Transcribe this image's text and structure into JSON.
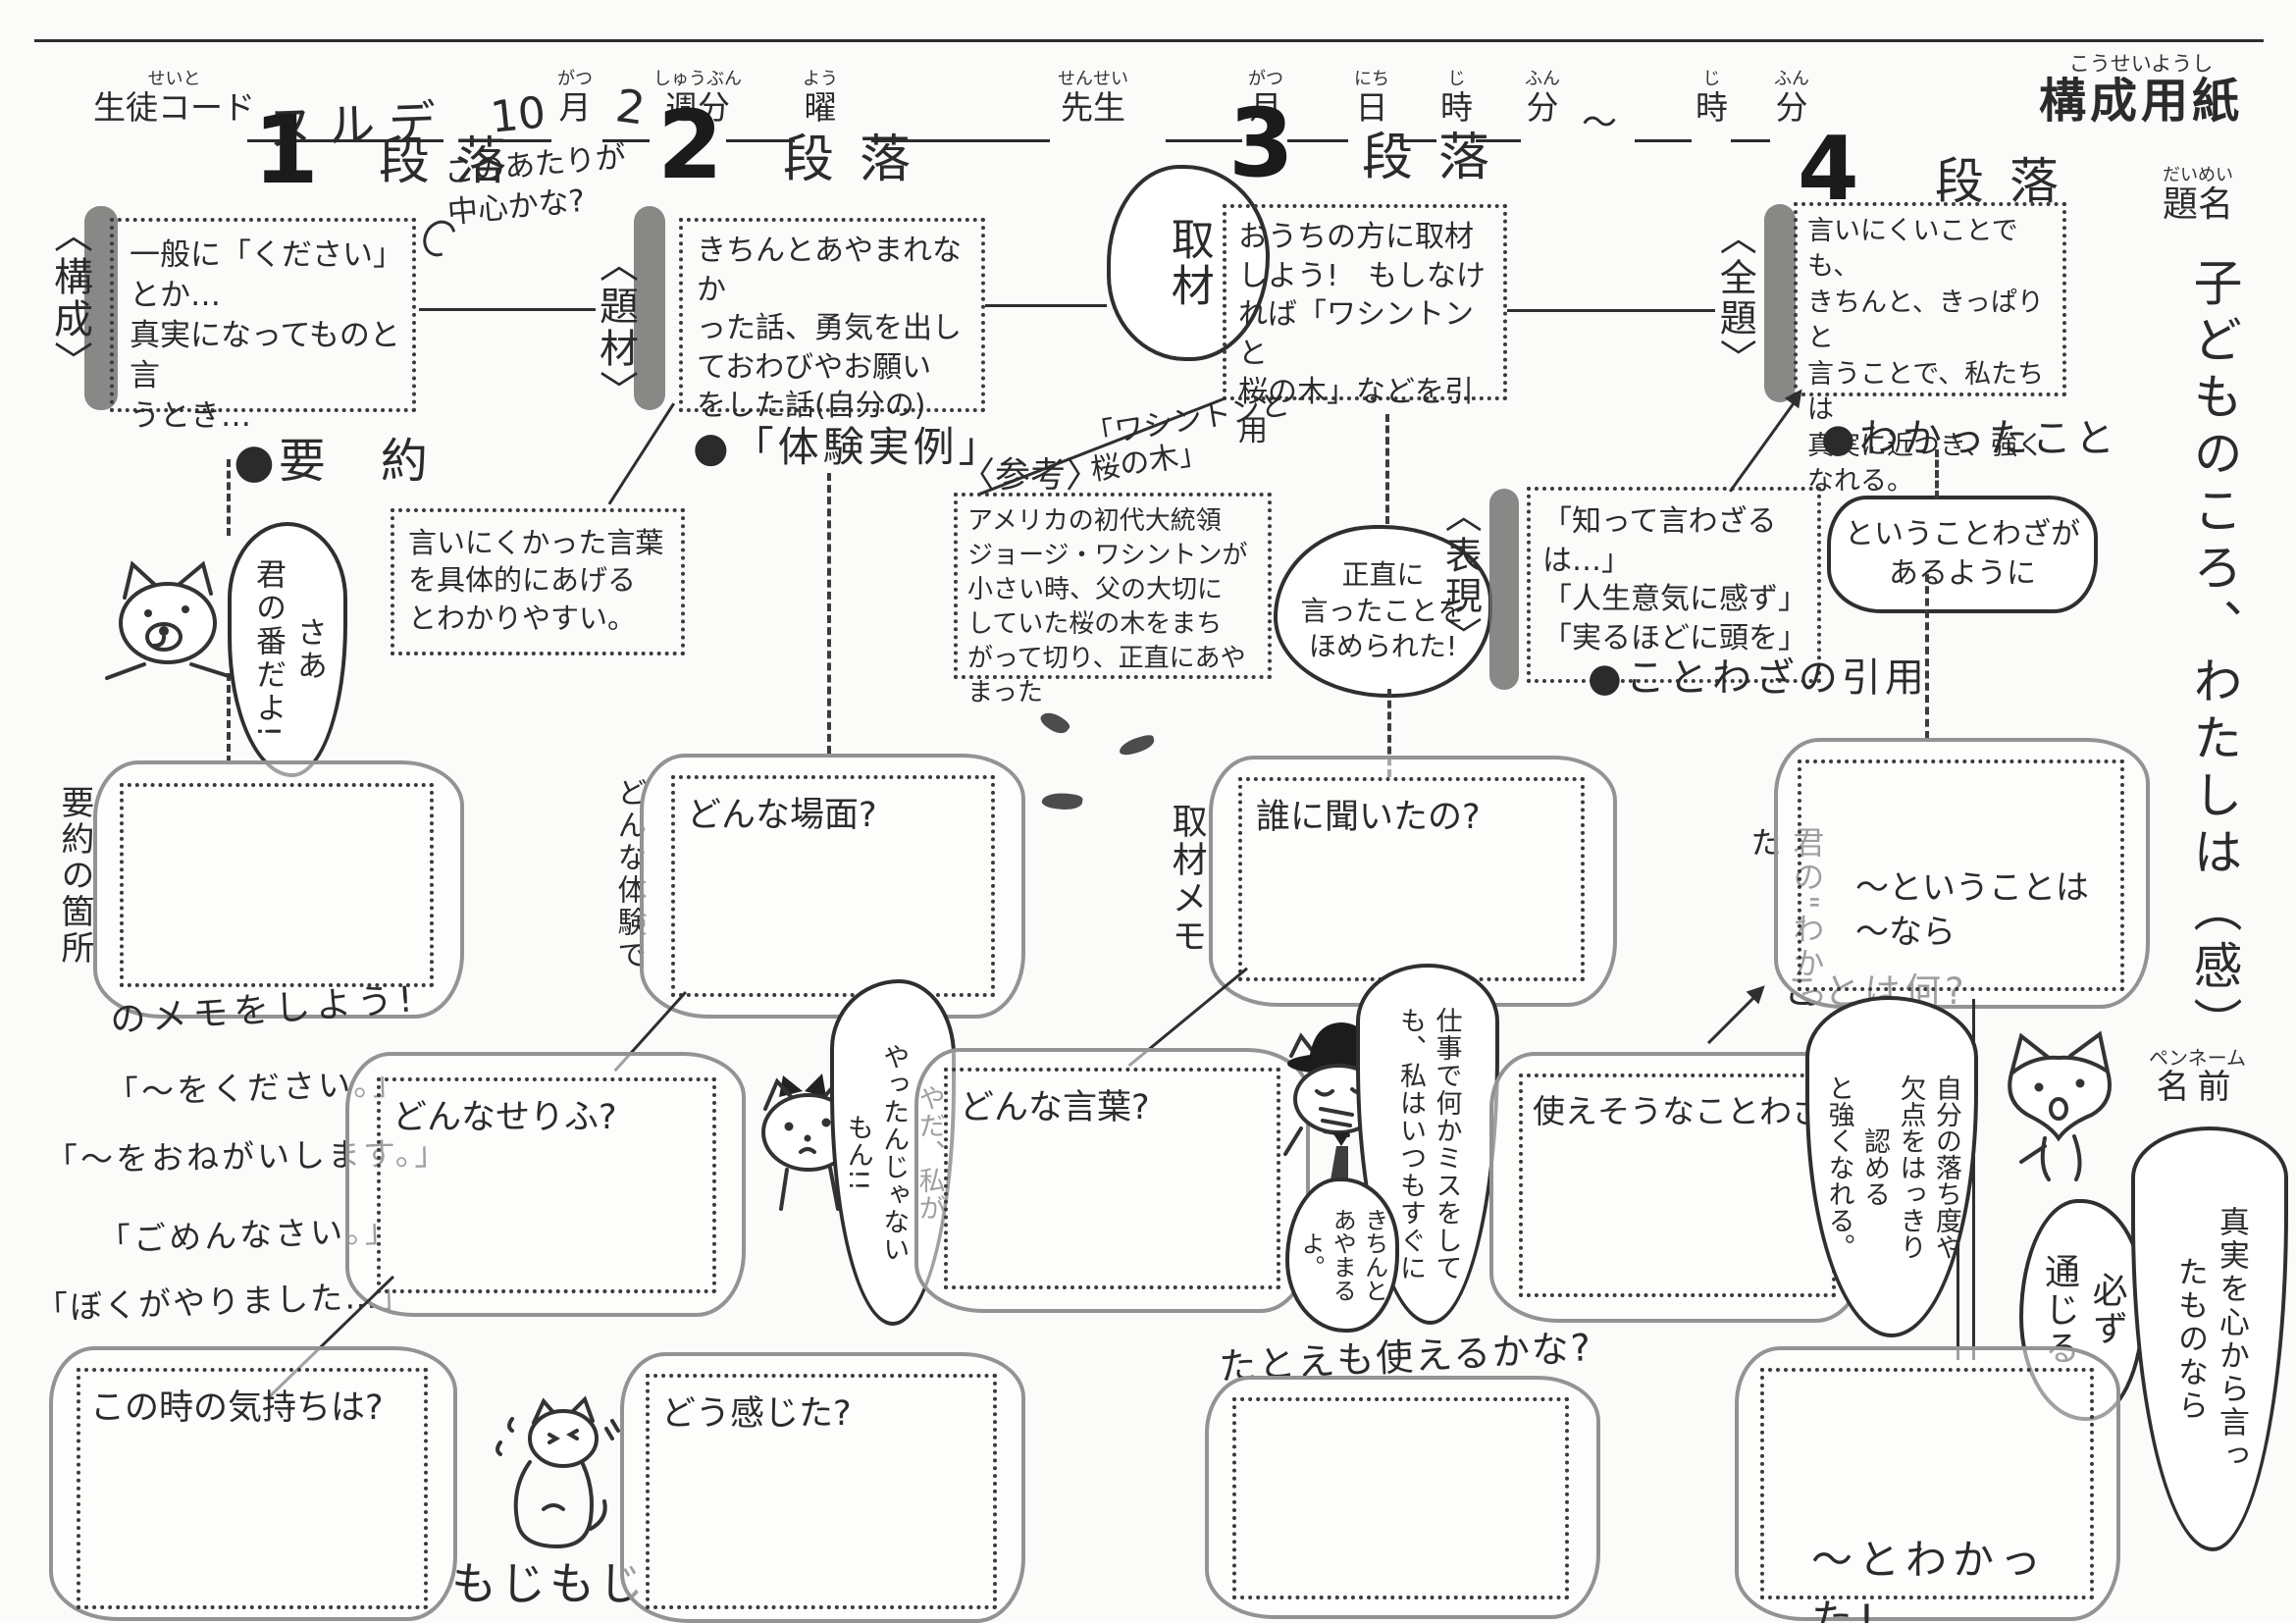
{
  "header": {
    "seito_ruby": "せいと",
    "seito": "生徒コード",
    "code_value": "ヌルデ",
    "month_value": "10",
    "gatsu_ruby": "がつ",
    "gatsu": "月",
    "week_value": "2",
    "shuubun_ruby": "しゅうぶん",
    "shuubun": "週分",
    "you_ruby": "よう",
    "you": "曜",
    "sensei_ruby": "せんせい",
    "sensei": "先生",
    "gatsu2_ruby": "がつ",
    "gatsu2": "月",
    "nichi_ruby": "にち",
    "nichi": "日",
    "ji_ruby": "じ",
    "ji": "時",
    "fun_ruby": "ふん",
    "fun": "分",
    "tilde": "〜",
    "ji2_ruby": "じ",
    "ji2": "時",
    "fun2_ruby": "ふん",
    "fun2": "分",
    "sheet_title_ruby": "こうせいようし",
    "sheet_title": "構成用紙"
  },
  "sections": {
    "s1": {
      "num": "1",
      "danraku": "段落",
      "tag": "〈構成〉",
      "box": "一般に「ください」とか…\n真実になってものと言\nうとき…",
      "bullet": "●要　約"
    },
    "s2": {
      "num": "2",
      "danraku": "段落",
      "tag": "〈題材〉",
      "note": "このあたりが\n中心かな?",
      "box": "きちんとあやまれなか\nった話、勇気を出し\nておわびやお願い\nをした話(自分の)",
      "bullet": "●「体験実例」"
    },
    "s3": {
      "num": "3",
      "danraku": "段落",
      "tag": "取材",
      "box": "おうちの方に取材\nしよう!　もしなけ\nれば「ワシントンと\n桜の木」などを引用"
    },
    "s4": {
      "num": "4",
      "danraku": "段落",
      "tag": "〈全題〉",
      "box": "言いにくいことでも、\nきちんと、きっぱりと\n言うことで、私たちは\n真実に近つき、強く\nなれる。",
      "bullet": "●わかったこと"
    }
  },
  "middle": {
    "hint": "言いにくかった言葉\nを具体的にあげる\nとわかりやすい。",
    "sankou_tag": "〈参考〉",
    "sankou_title": "「ワシントンと\n桜の木」",
    "sankou_box": "アメリカの初代大統領\nジョージ・ワシントンが\n小さい時、父の大切に\nしていた桜の木をまち\nがって切り、正直にあやまった",
    "praise_bubble": "正直に\n言ったことを\nほめられた!",
    "hyougen_tag": "〈表現〉",
    "hyougen_box": "「知って言わざるは…」\n「人生意気に感ず」\n「実るほどに頭を」",
    "hyougen_bullet": "●ことわざの引用",
    "kotowaza_comment": "ということわざが\nあるように"
  },
  "left": {
    "dog_bubble": "さあ\n君の番だよ!",
    "memo_vert": "要約の箇所",
    "memo_horiz": "のメモをしよう!",
    "quotes": [
      "「〜をください。」",
      "「〜をおねがいします。」",
      "「ごめんなさい。」",
      "「ぼくがやりました…」"
    ]
  },
  "clouds": {
    "scene_label": "どんな場面?",
    "scene_side": "どんな体験で",
    "interview_label": "誰に聞いたの?",
    "interview_side": "取材メモ",
    "serifu_label": "どんなせりふ?",
    "words_label": "どんな言葉?",
    "proverb_label": "使えそうなことわざ",
    "tatoe_label": "たとえも使えるかな?",
    "feelings_label": "この時の気持ちは?",
    "felt_label": "どう感じた?",
    "understood_label": "〜ということは\n〜なら",
    "wakatta_label": "〜とわかった!"
  },
  "right": {
    "daimei_ruby": "だいめい",
    "daimei": "題名",
    "title_vertical": "子どものころ、わたしは（感）",
    "penname_ruby": "ペンネーム",
    "penname": "名前",
    "kimi_vert": "君の\"わかった",
    "kimi_horiz": "ことは何?",
    "jibun_bubble": "自分の落ち度や\n欠点をはっきり\n認める\nと強くなれる。",
    "fox_bubble1": "必ず\n通じる",
    "fox_bubble2": "真実を心から言っ\nたものなら"
  },
  "characters": {
    "mojimoji": "もじもじ",
    "cat_no_bubble": "やだ、私が\nやったんじゃない\nもん!!",
    "detective_bubble": "仕事で何かミスをして\nも、私はいつもすぐに",
    "detective_bubble_small": "きちんと\nあやまる\nよ。"
  }
}
